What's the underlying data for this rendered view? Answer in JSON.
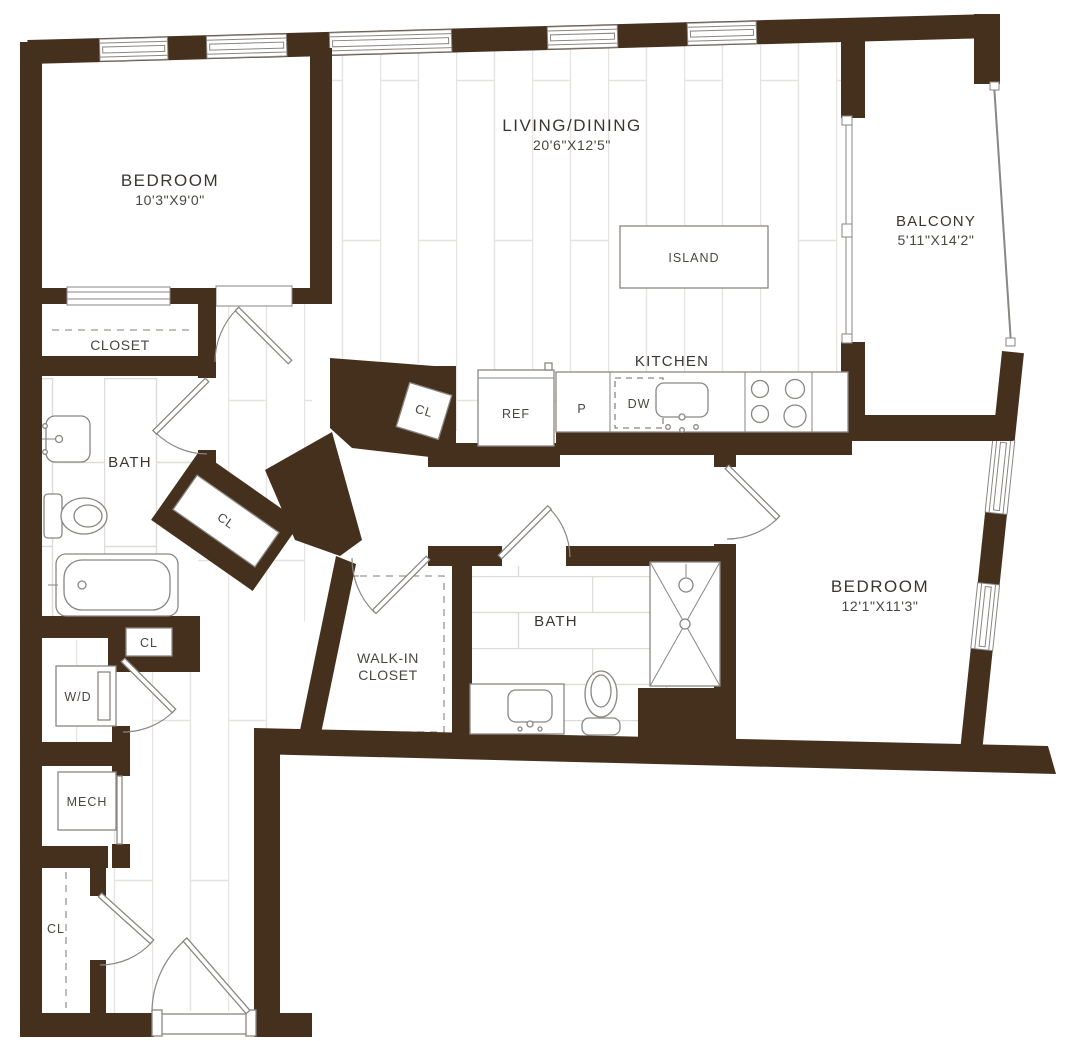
{
  "plan": {
    "colors": {
      "wall": "#45301d",
      "fixture_line": "#8a8682",
      "text": "#3a3633",
      "floor_line": "#e6e3e0"
    },
    "rooms": {
      "bedroom1": {
        "name": "BEDROOM",
        "dims": "10'3\"X9'0\""
      },
      "living": {
        "name": "LIVING/DINING",
        "dims": "20'6\"X12'5\""
      },
      "balcony": {
        "name": "BALCONY",
        "dims": "5'11\"X14'2\""
      },
      "bedroom2": {
        "name": "BEDROOM",
        "dims": "12'1\"X11'3\""
      },
      "kitchen": {
        "name": "KITCHEN"
      },
      "bath1": {
        "name": "BATH"
      },
      "bath2": {
        "name": "BATH"
      },
      "closet": {
        "name": "CLOSET"
      },
      "walk_in_closet": {
        "line1": "WALK-IN",
        "line2": "CLOSET"
      },
      "laundry": {
        "name": "W/D"
      },
      "mechanical": {
        "name": "MECH"
      },
      "closet_abbr": {
        "name": "CL"
      }
    },
    "fixtures": {
      "island": "ISLAND",
      "refrigerator": "REF",
      "pantry": "P",
      "dishwasher": "DW"
    }
  }
}
